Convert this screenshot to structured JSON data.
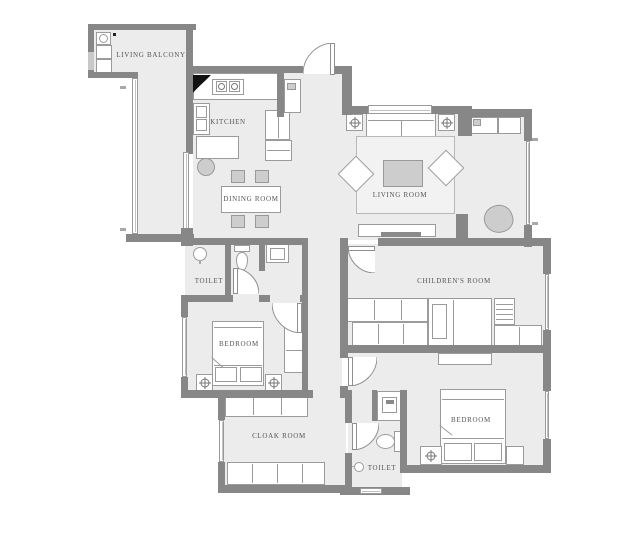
{
  "title": "apartment floor plan",
  "rooms": [
    {
      "id": "living-balcony",
      "label": "LIVING BALCONY"
    },
    {
      "id": "kitchen",
      "label": "KITCHEN"
    },
    {
      "id": "dining-room",
      "label": "DINING ROOM"
    },
    {
      "id": "living-room",
      "label": "LIVING ROOM"
    },
    {
      "id": "toilet-upper",
      "label": "TOILET"
    },
    {
      "id": "bedroom-left",
      "label": "BEDROOM"
    },
    {
      "id": "childrens-room",
      "label": "CHILDREN'S ROOM"
    },
    {
      "id": "bedroom-right",
      "label": "BEDROOM"
    },
    {
      "id": "cloak-room",
      "label": "CLOAK ROOM"
    },
    {
      "id": "toilet-lower",
      "label": "TOILET"
    }
  ],
  "colors": {
    "wall": "#878787",
    "floor": "#ececec",
    "outline": "#9b9b9b",
    "furniture": "#ffffff",
    "shaded_furniture": "#cdcdcd",
    "label_text": "#555555"
  }
}
